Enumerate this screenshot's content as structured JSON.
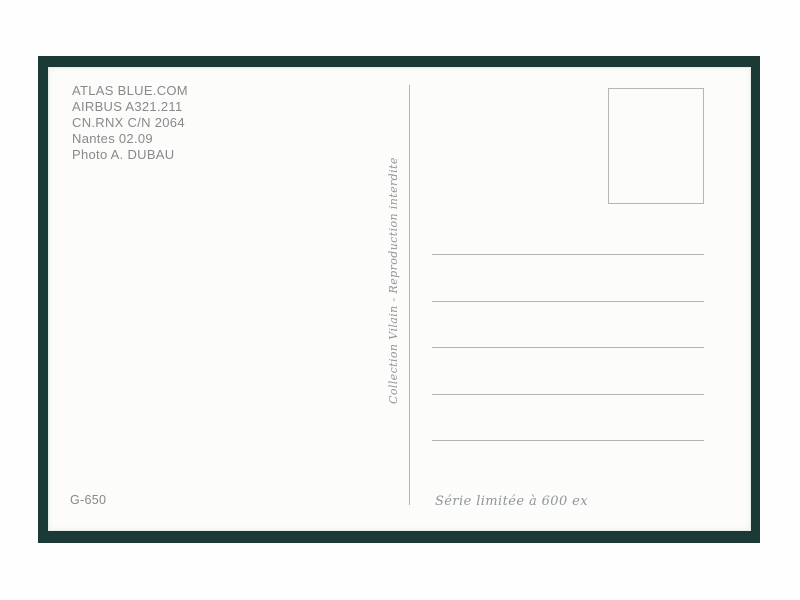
{
  "postcard": {
    "info_block": {
      "lines": [
        "ATLAS BLUE.COM",
        "AIRBUS A321.211",
        "CN.RNX C/N 2064",
        "Nantes 02.09",
        "Photo A. DUBAU"
      ]
    },
    "vertical_credit": "Collection Vilain - Reproduction interdite",
    "reference_code": "G-650",
    "edition_note": "Série limitée à 600 ex",
    "address_lines": {
      "count": 5,
      "first_top_px": 187,
      "spacing_px": 46.5
    },
    "colors": {
      "frame": "#1c3a35",
      "card": "#fcfcfa",
      "info_text": "#87898b",
      "script_text": "#8e9598",
      "rule": "#b0b6b4"
    }
  }
}
